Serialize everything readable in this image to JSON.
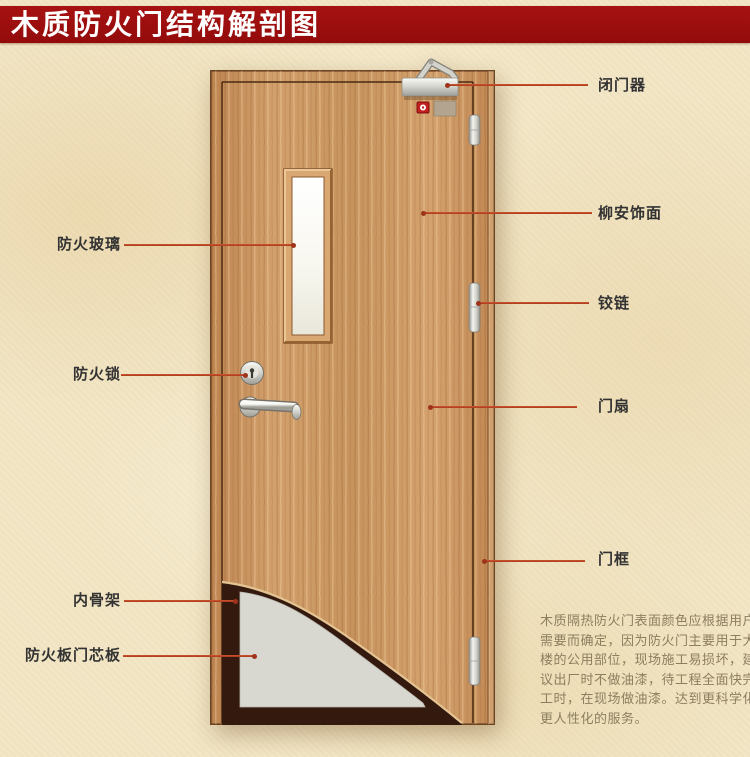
{
  "title": "木质防火门结构解剖图",
  "labels": {
    "fire_glass": "防火玻璃",
    "fire_lock": "防火锁",
    "inner_frame": "内骨架",
    "core_board": "防火板门芯板",
    "door_closer": "闭门器",
    "veneer": "柳安饰面",
    "hinge": "铰链",
    "door_leaf": "门扇",
    "door_frame": "门框"
  },
  "description": {
    "lines": [
      "木质隔热防火门表面颜色应根据用户",
      "需要而确定，因为防火门主要用于大",
      "楼的公用部位，现场施工易损坏，建",
      "议出厂时不做油漆，待工程全面快完",
      "工时，在现场做油漆。达到更科学化",
      "更人性化的服务。"
    ]
  },
  "colors": {
    "banner": "#9c0f0f",
    "banner_text": "#ffffff",
    "background": "#f2e6c6",
    "label_text": "#333333",
    "pointer_line": "#c0472a",
    "wood": "#cd9763",
    "glass": "#ffffff",
    "core_gray": "#d9d8d0",
    "cutaway_dark": "#33190e",
    "description_text": "#8d7e60"
  }
}
